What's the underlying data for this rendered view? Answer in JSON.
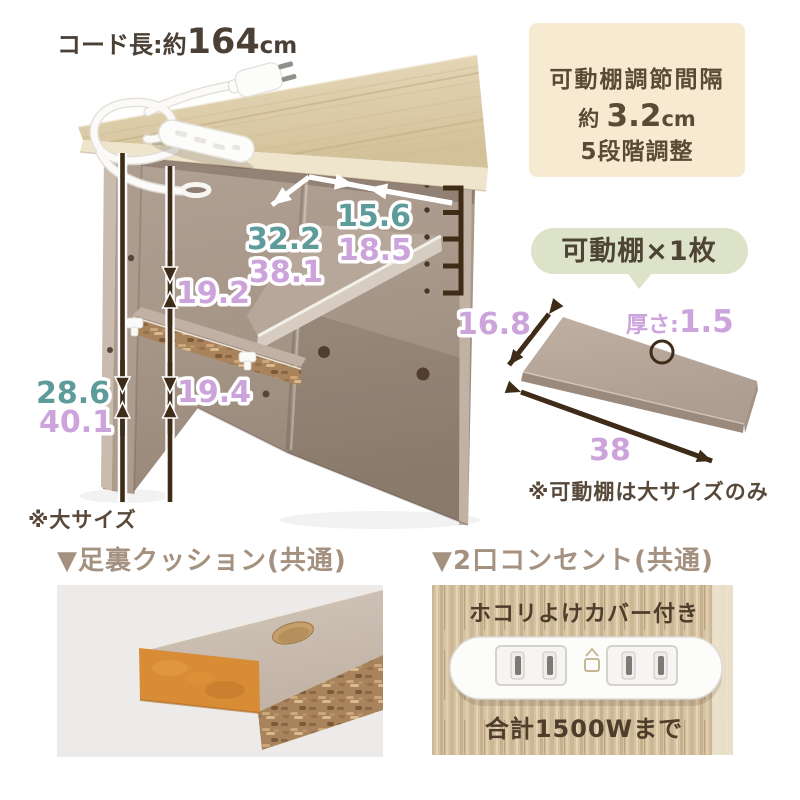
{
  "colors": {
    "accent_teal": "#5E9C9C",
    "accent_purple": "#CCA3DB",
    "arrow_brown": "#3E2B18",
    "spec_box_beige": "#F6EBD1",
    "badge_green": "#DCE3C9",
    "title_taupe": "#A5917F",
    "note_brown": "#57483A"
  },
  "cord_label": {
    "prefix": "コード長:約",
    "value": "164",
    "unit": "cm"
  },
  "spec_box": {
    "line1": "可動棚調節間隔",
    "line2_prefix": "約 ",
    "line2_value": "3.2",
    "line2_unit": "cm",
    "line3": "5段階調整"
  },
  "shelf_badge": {
    "label": "可動棚×1枚"
  },
  "diagram": {
    "depth_small": "15.6",
    "depth_large": "18.5",
    "width_small": "32.2",
    "width_large": "38.1",
    "upper_gap": "19.2",
    "lower_gap": "19.4",
    "height_small": "28.6",
    "height_large": "40.1",
    "size_note": "※大サイズ"
  },
  "shelf_diagram": {
    "depth": "16.8",
    "thickness_label": "厚さ:",
    "thickness_value": "1.5",
    "width": "38",
    "note": "※可動棚は大サイズのみ"
  },
  "cushion_section": {
    "title": "▼足裏クッション(共通)"
  },
  "outlet_section": {
    "title": "▼2口コンセント(共通)",
    "cover_note": "ホコリよけカバー付き",
    "wattage_note": "合計1500Wまで"
  }
}
